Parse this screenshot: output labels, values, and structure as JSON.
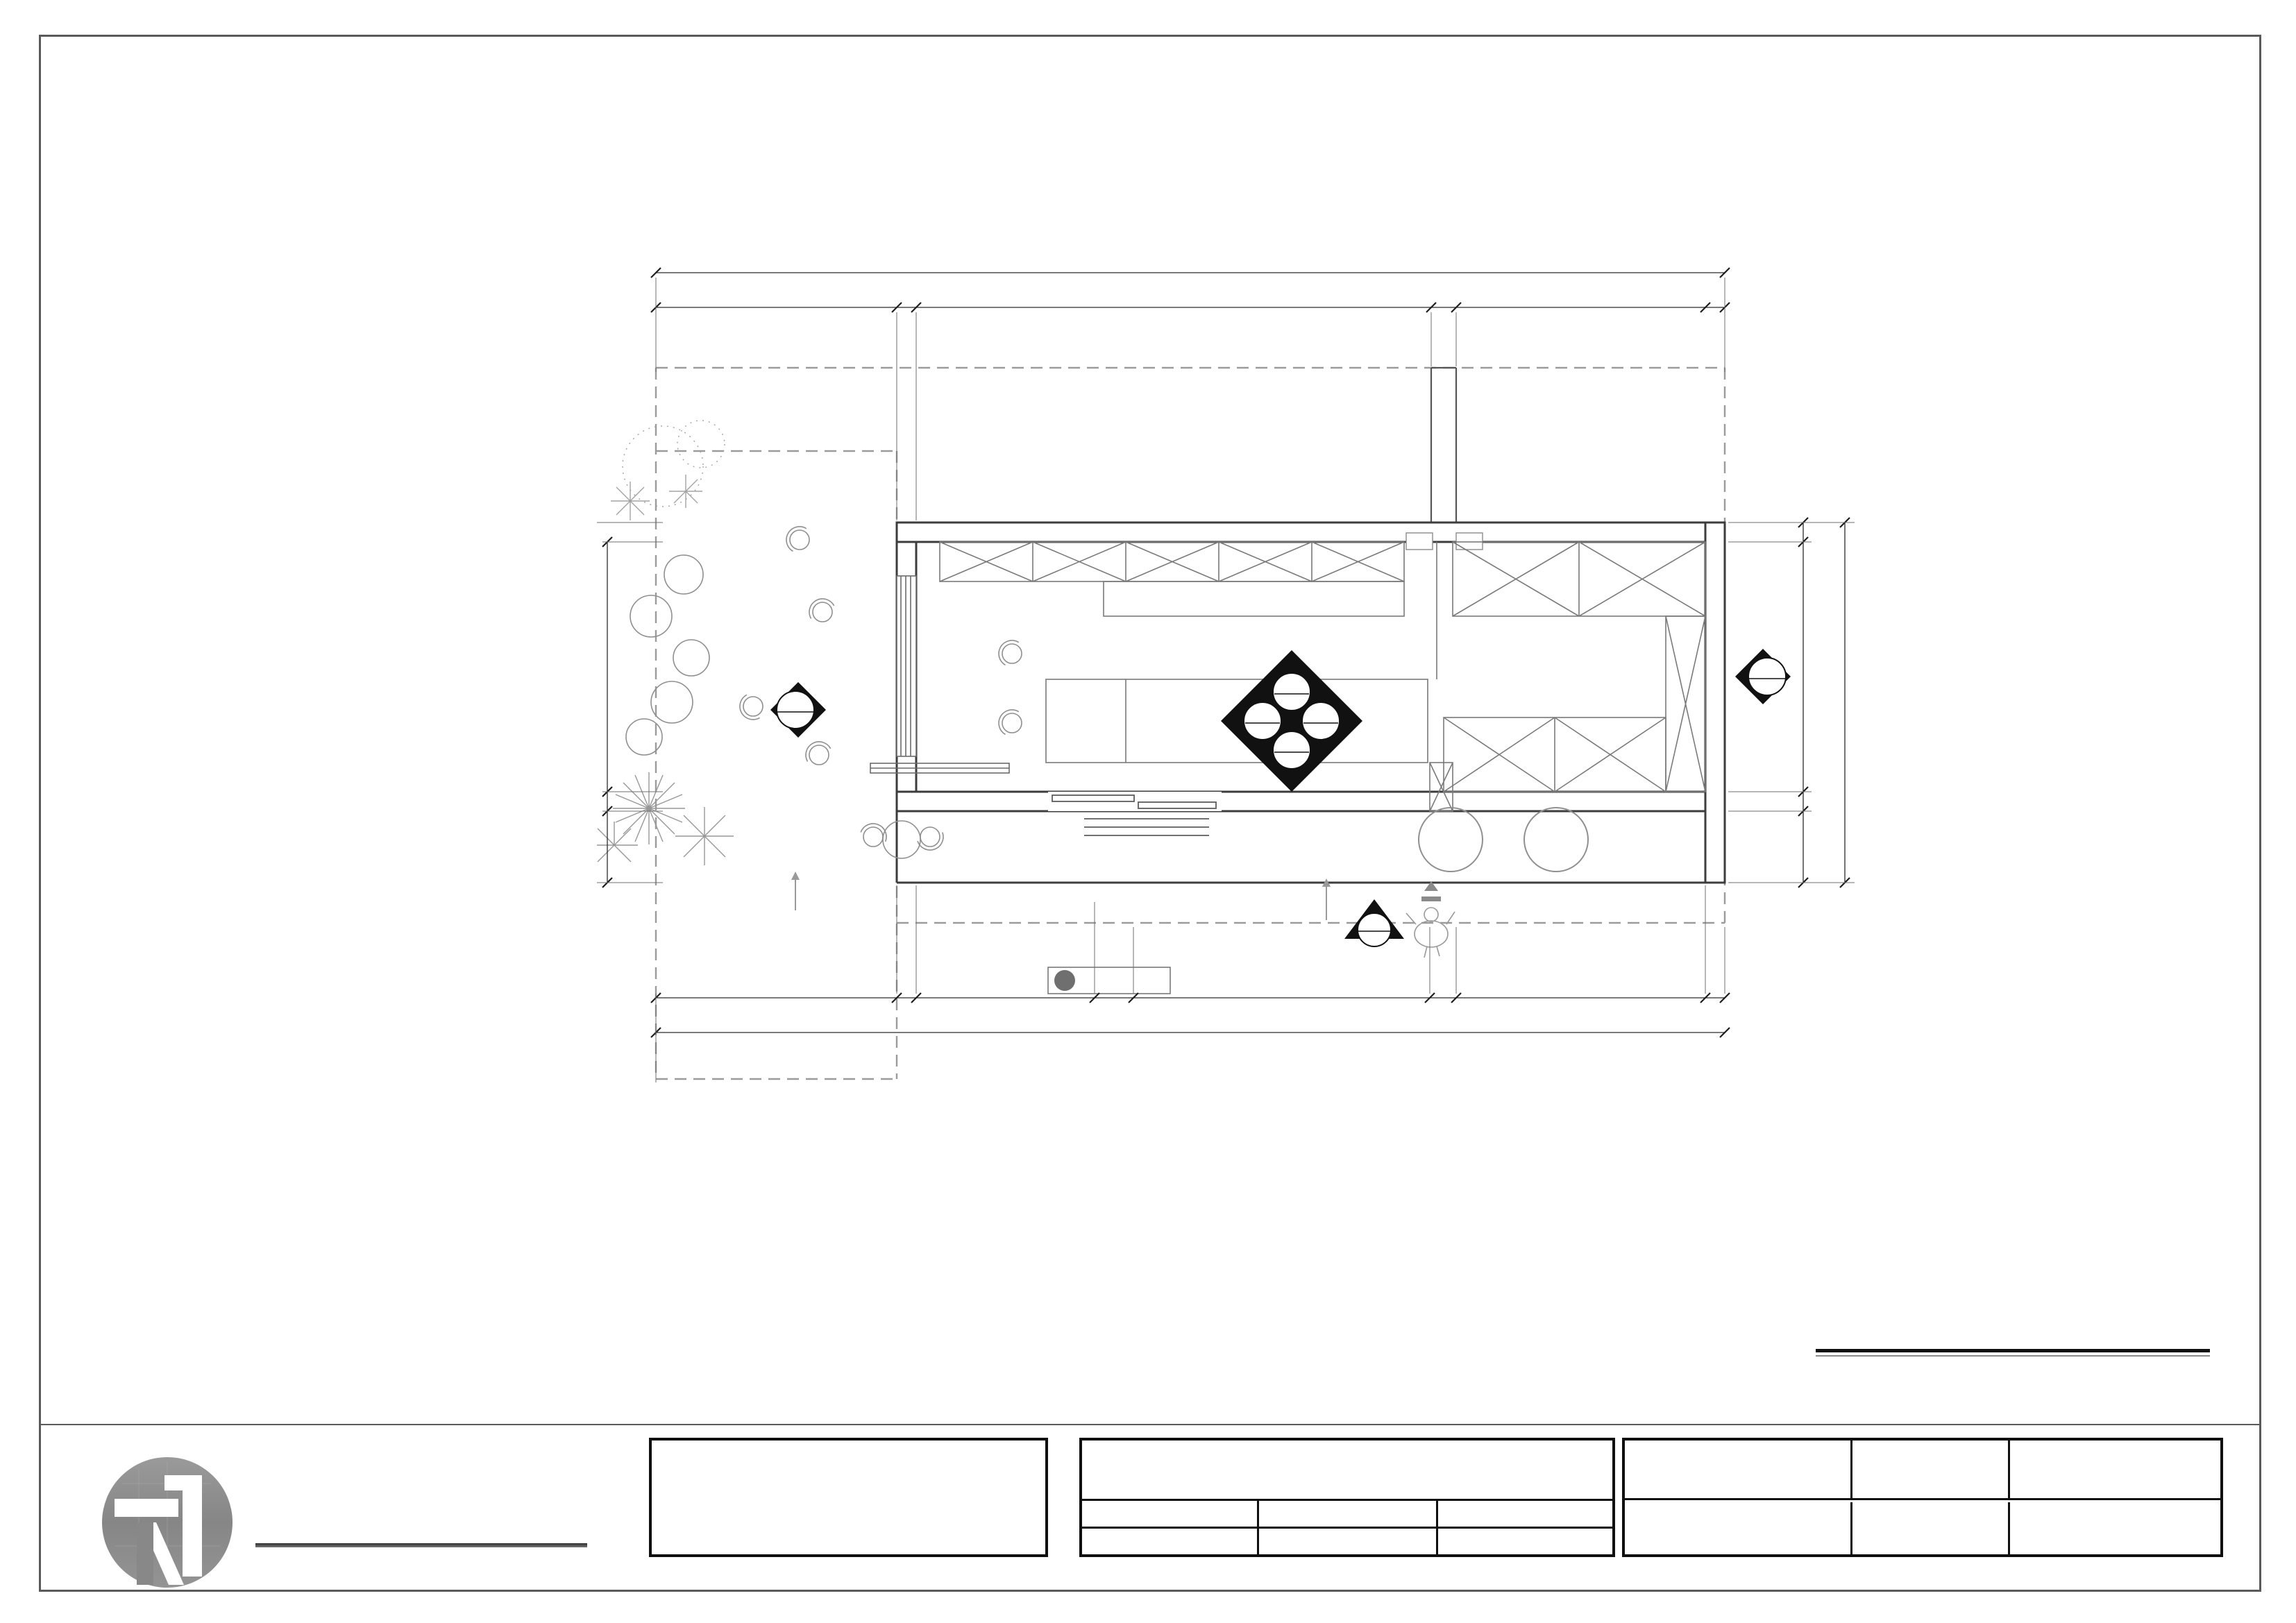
{
  "drawing_title": {
    "en": "Original structure drawing",
    "cn": "立面索引图",
    "scale_label": "SCALE",
    "scale_value": "1:60"
  },
  "dimensions": {
    "top": {
      "total": "11980",
      "segs": [
        "2700",
        "220",
        "5770",
        "280",
        "2790",
        "220"
      ]
    },
    "bottom": {
      "total": "11980",
      "segs": [
        "2700",
        "220",
        "2000",
        "432",
        "3323",
        "1280",
        "2790",
        "220"
      ]
    },
    "left": {
      "total": "4040",
      "segs": [
        "2800",
        "220",
        "800"
      ]
    },
    "right": {
      "total": "4040",
      "segs": [
        "220",
        "2800",
        "220",
        "800"
      ]
    }
  },
  "plan_labels": {
    "display_cabinet_top": "展示柜",
    "storage_cabinet": "储物柜",
    "storage_room_1": "储物室",
    "storage_room_2": "储物室",
    "display_freezer": "展示冰柜",
    "bar_counter": "吧台",
    "display_cabinet_bottom": "展示柜",
    "top_hung_window": "上翻窗户",
    "strong_power_box": "强电箱",
    "weak_power_box": "弱电箱",
    "step_up_one": "上一步H:100",
    "step_up_two": "上两步"
  },
  "elevation_markers": {
    "center_top_num": "1",
    "center_top_ref": "EL3-01",
    "center_right_num": "2",
    "center_right_ref": "EL4-01",
    "center_bottom_num": "3",
    "center_bottom_ref": "EL5-01",
    "center_left_num": "4",
    "center_left_ref": "EL4-02",
    "left_num": "2",
    "left_ref": "EL2-02",
    "right_num": "4",
    "right_ref": "EL2-01",
    "entry_num": "1",
    "entry_ref": "EL1-01"
  },
  "brand": {
    "logo_cn": "NASO那所空间设计",
    "logo_en": "NASO  SPACE  DESIGN  LIMITED  COOMPANY"
  },
  "copyright": {
    "l1": "THIS DRAWING IS COPYRIGHT.",
    "l2": "THE CONTRACTOR IS TO CHECK & VERIFY ALL DIMENSIONS PRIOR TO PROCEEDING WORK.",
    "l3": "FIGURED DIMENSIONS TO BE READ IN PREFERENCE OF SCALE MEASUREMENT.",
    "l4": "ANY DISCREPANCIES FOUND SHALL BE REPORT TO THE INTERIOR DESIGNER."
  },
  "title_block": {
    "project_label": "项目名称    :",
    "project_cn": "南宁·双签龟苓膏·民歌湖店装饰改造",
    "project_en": "NANNING · GUANGMING CITY YINQIYUAN",
    "design_label": "设  计  :",
    "design_value": "玉工",
    "review_label": "审  校  :",
    "review_value": "陈工",
    "scale_label": "SCALE",
    "scale_sep": ":",
    "scale_value": "1:60",
    "draw_label": "绘  图  :",
    "draw_value": "冯工",
    "pm_label": "项目负责:",
    "date_label": "DATE",
    "date_sep": ":",
    "date_value": "2025-05",
    "sheet_label": "图纸名称:",
    "sheet_value": "立面索引图",
    "no_label": "DRAWING NO:",
    "no_value": "PM-11",
    "party_label": "甲方（业主）",
    "party_label2": "会签:",
    "note": "注: 所有图纸中涉及到的尺寸及施工工艺的微调均以现场施工情况为准.",
    "seal1": "执业签章:",
    "seal2": "出图签章:"
  }
}
